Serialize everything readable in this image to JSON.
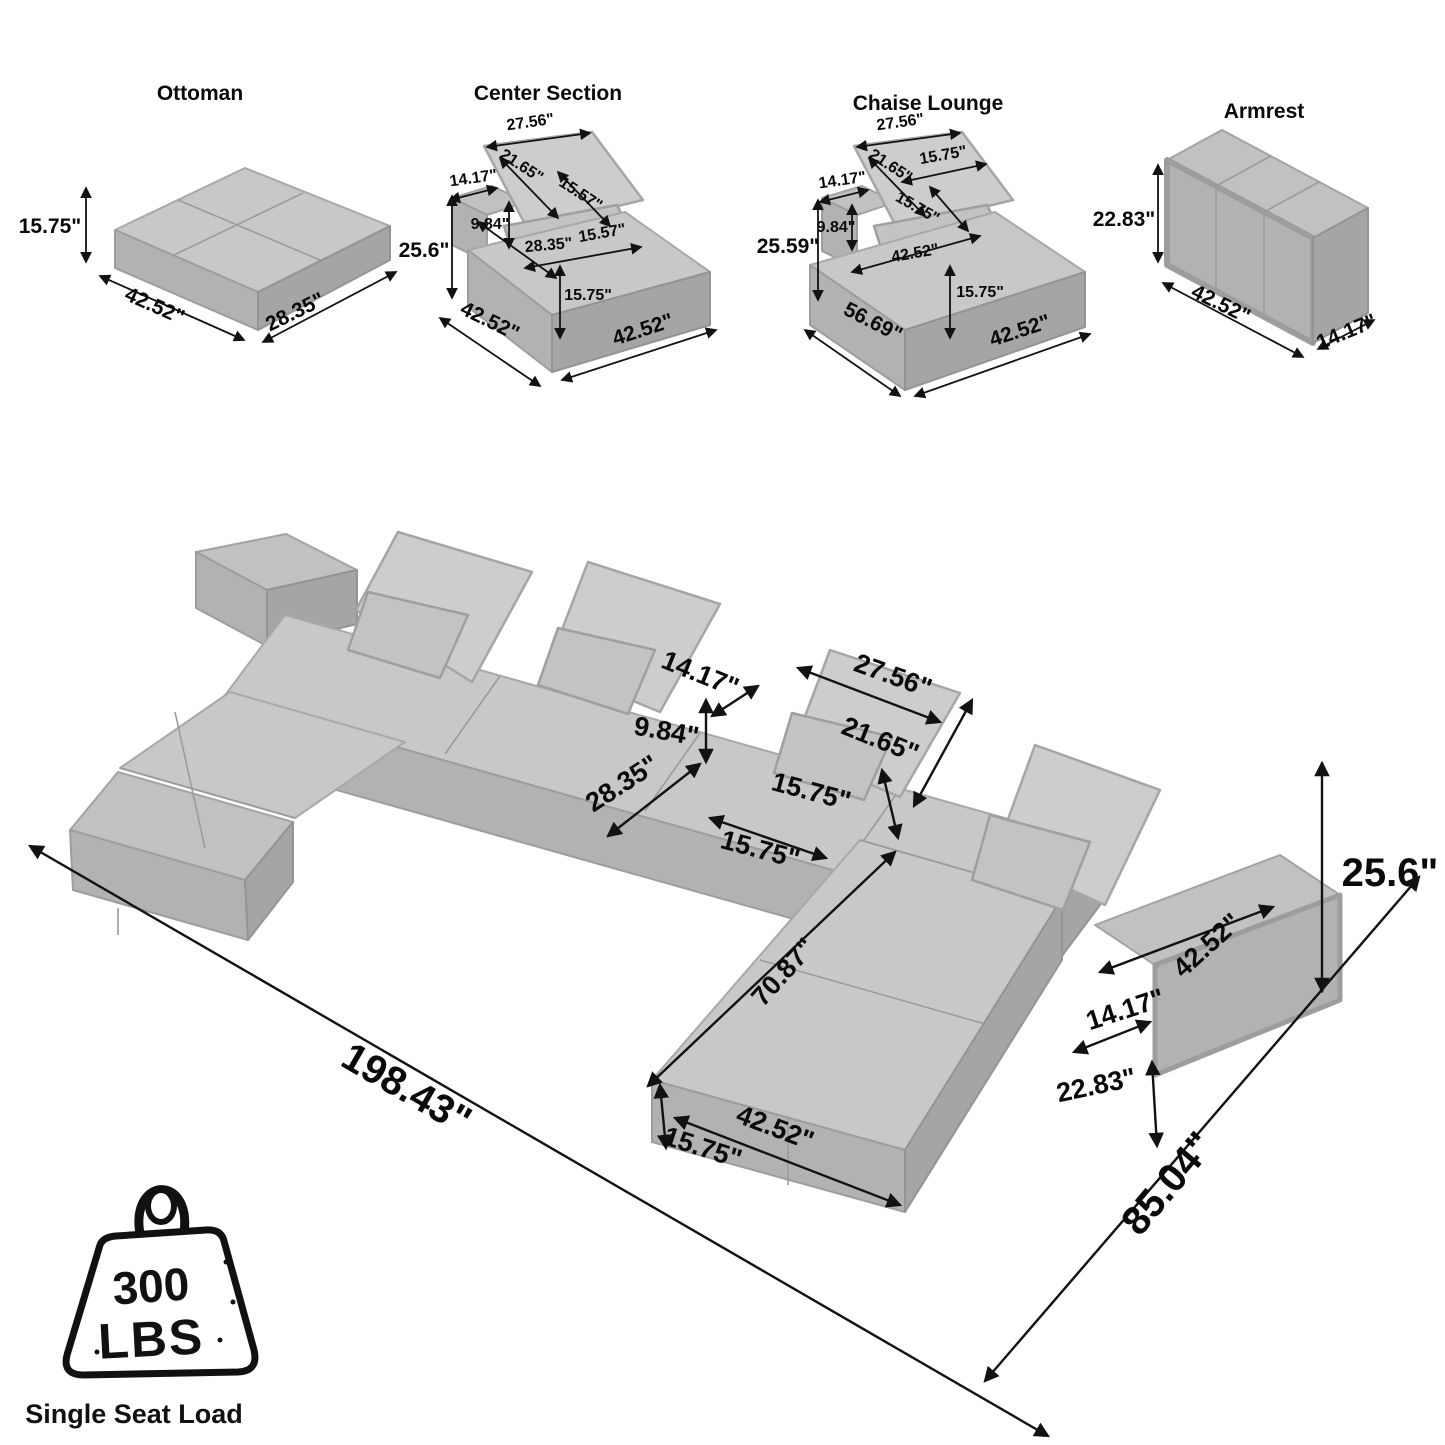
{
  "panels": {
    "ottoman": {
      "title": "Ottoman",
      "height": "15.75\"",
      "length": "42.52\"",
      "depth": "28.35\""
    },
    "center_section": {
      "title": "Center Section",
      "pillow_width": "27.56\"",
      "pillow_diagonal": "21.65\"",
      "small_pillow_side": "15.57\"",
      "small_pillow_bottom": "15.57\"",
      "back_width": "14.17\"",
      "back_height": "9.84\"",
      "overall_height": "25.6\"",
      "seat_depth": "28.35\"",
      "seat_height": "15.75\"",
      "bottom_left": "42.52\"",
      "bottom_right": "42.52\""
    },
    "chaise_lounge": {
      "title": "Chaise Lounge",
      "pillow_width": "27.56\"",
      "pillow_diagonal": "21.65\"",
      "small_pillow_top": "15.75\"",
      "small_pillow_side": "15.75\"",
      "back_width": "14.17\"",
      "back_height": "9.84\"",
      "overall_height": "25.59\"",
      "seat_width": "42.52\"",
      "depth": "56.69\"",
      "seat_height": "15.75\"",
      "bottom_right": "42.52\""
    },
    "armrest": {
      "title": "Armrest",
      "height": "22.83\"",
      "length": "42.52\"",
      "depth": "14.17\""
    }
  },
  "main": {
    "back_width": "14.17\"",
    "back_height": "9.84\"",
    "seat_depth": "28.35\"",
    "pillow_width": "27.56\"",
    "pillow_diagonal": "21.65\"",
    "pillow_height": "15.75\"",
    "pillow_bottom": "15.75\"",
    "chaise_length": "70.87\"",
    "armrest_length": "42.52\"",
    "armrest_width": "14.17\"",
    "armrest_height": "22.83\"",
    "ottoman_width": "42.52\"",
    "ottoman_height": "15.75\"",
    "overall_length": "198.43\"",
    "overall_depth": "85.04\"",
    "overall_height": "25.6\""
  },
  "badge": {
    "value": "300",
    "unit": "LBS",
    "caption": "Single Seat Load"
  }
}
